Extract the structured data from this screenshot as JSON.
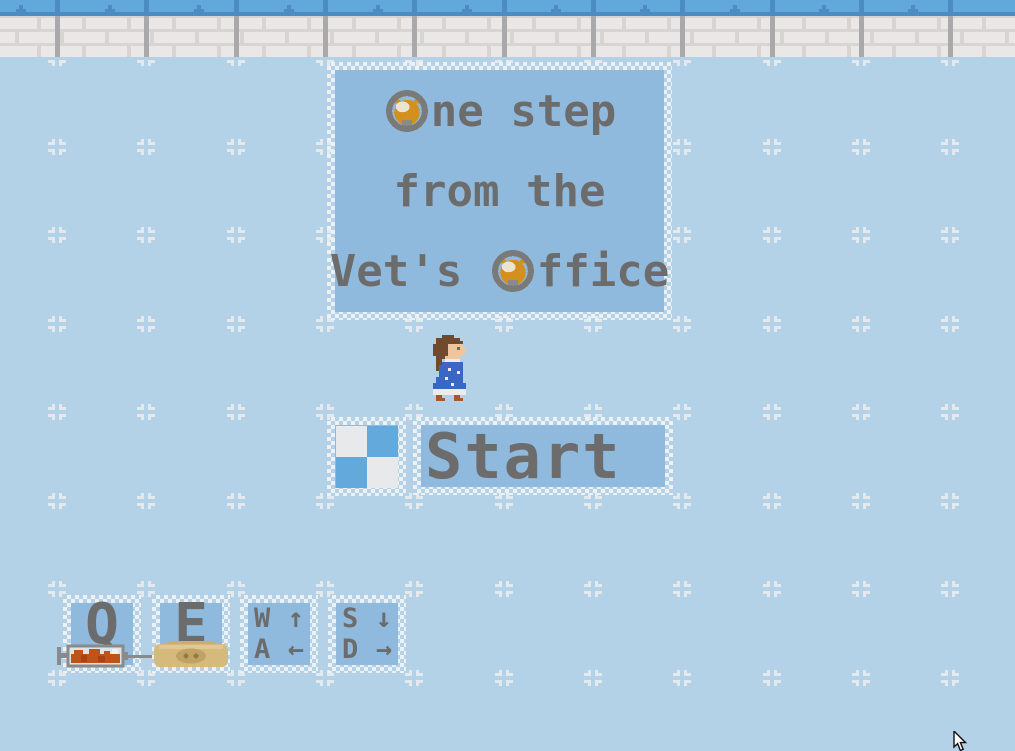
{
  "title_panel": {
    "full_text": "One step from the Vet's Office",
    "line1": {
      "icon": "cat-in-o-icon",
      "rest": "ne step"
    },
    "line2": "from the",
    "line3": {
      "pre": "Vet's ",
      "icon": "cat-in-o-icon",
      "rest": "ffice"
    }
  },
  "menu": {
    "start_button": {
      "label": "Start",
      "icon": "checker-tile-icon"
    }
  },
  "character": {
    "sprite": "girl-blue-dress-sprite"
  },
  "controls_help": [
    {
      "key": "Q",
      "icon": "syringe-icon"
    },
    {
      "key": "E",
      "icon": "pill-icon"
    },
    {
      "rows": [
        {
          "key": "W",
          "arrow": "↑"
        },
        {
          "key": "A",
          "arrow": "←"
        }
      ]
    },
    {
      "rows": [
        {
          "key": "S",
          "arrow": "↓"
        },
        {
          "key": "D",
          "arrow": "→"
        }
      ]
    }
  ],
  "colors": {
    "floor_blue": "#b3d1e7",
    "panel_blue": "#8fbadd",
    "text_gray": "#6c6c6c",
    "checker_white": "#eef1f3",
    "sky_blue": "#62a8db",
    "sky_line_blue": "#4d8cc2",
    "brick_white": "#eae8e6",
    "mortar_gray": "#d7d4d2",
    "divider_gray": "#a9a9ab",
    "marker_white": "#e4e9ed",
    "tile_blue": "#64a9dc",
    "tile_white": "#e7e9eb",
    "cat_orange": "#d3901e",
    "syringe_orange": "#c25317",
    "pill_tan": "#d6b97c"
  }
}
